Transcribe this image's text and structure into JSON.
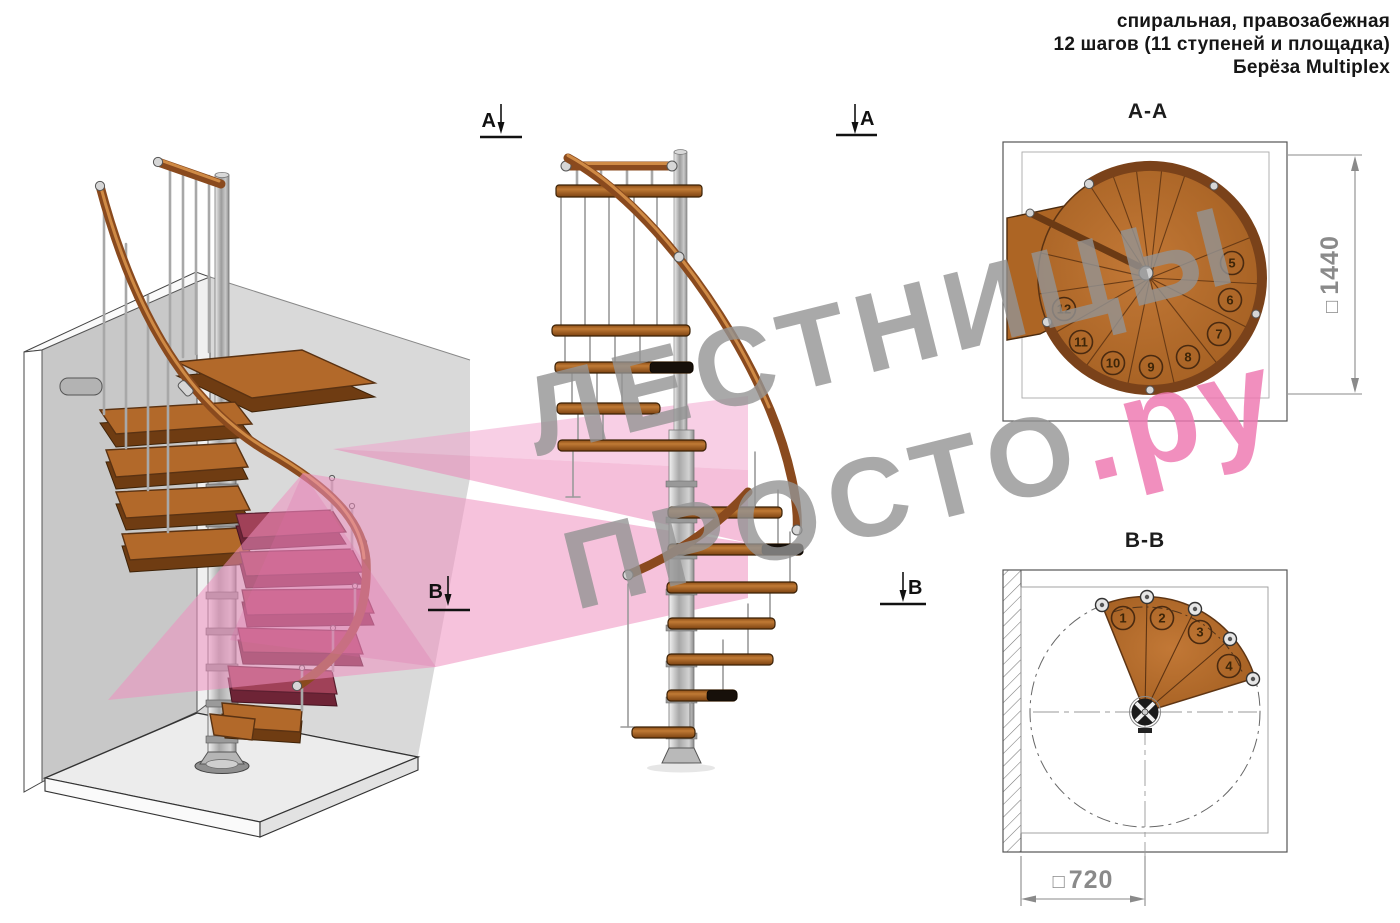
{
  "annotation": {
    "line1": "спиральная, правозабежная",
    "line2": "12 шагов (11 ступеней и площадка)",
    "line3": "Берёза Multiplex"
  },
  "views": {
    "aa": {
      "title": "А-А",
      "dimension_prefix": "□",
      "dimension_value": "1440",
      "step_numbers": [
        "5",
        "6",
        "7",
        "8",
        "9",
        "10",
        "11",
        "12"
      ]
    },
    "bb": {
      "title": "В-В",
      "dimension_prefix": "□",
      "dimension_value": "720",
      "step_numbers": [
        "1",
        "2",
        "3",
        "4"
      ]
    }
  },
  "section_markers": {
    "a": "А",
    "b": "В"
  },
  "watermark": {
    "line1": "ЛЕСТНИЦЫ",
    "line2_gray": "ПРОСТО",
    "line2_pink": ".ру"
  },
  "colors": {
    "wood": "#b2692a",
    "handrail": "#8a4a1e",
    "metal": "#b9b9b9",
    "section_highlight_pink": "#ee7fb3",
    "maroon_cut_steps": "#a04158",
    "watermark_gray": "#9a9a9a",
    "dimension_gray": "#8a8a8a"
  }
}
